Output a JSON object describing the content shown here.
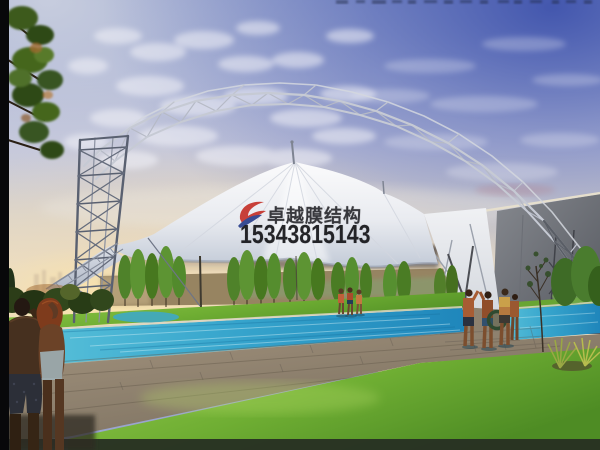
{
  "watermark": {
    "company_name": "卓越膜结构",
    "phone_number": "15343815143",
    "logo": "red-blue-swoosh-logo-icon",
    "text_color": "#1b1b1f"
  },
  "scene": {
    "type": "architectural-rendering",
    "subject": "White tensile membrane canopy with steel arch truss over an outdoor swimming pool at dusk",
    "elements": [
      "arch-truss",
      "lattice-tower",
      "membrane-roof",
      "mast-spire",
      "end-wall",
      "swimming-pool",
      "lawn",
      "wood-deck",
      "tree-row",
      "foreground-grass",
      "foreground-couple",
      "poolside-group-middle",
      "poolside-group-right"
    ],
    "palette": {
      "sky_top": "#5568b6",
      "sky_mid": "#c7c9dd",
      "sunset_glow": "#f4dfae",
      "membrane_white": "#f4f5f7",
      "steel_gray": "#c6cad4",
      "pool_water": "#35a0c8",
      "lawn_green": "#7cb83e",
      "grass_green": "#6fae33",
      "deck_tan": "#97897a",
      "wall_gray": "#6e7178",
      "foliage_dark": "#3c5a1d"
    }
  }
}
